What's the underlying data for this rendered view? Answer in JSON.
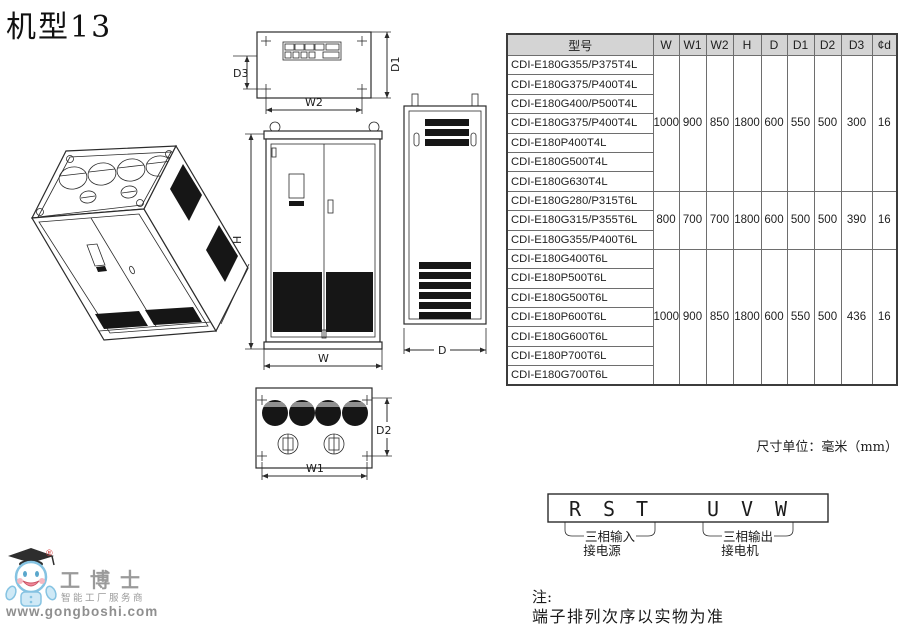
{
  "page": {
    "title": "机型13",
    "unit_note": "尺寸单位：毫米（mm）",
    "note_line1": "注:",
    "note_line2": "端子排列次序以实物为准"
  },
  "table": {
    "headers": [
      "型号",
      "W",
      "W1",
      "W2",
      "H",
      "D",
      "D1",
      "D2",
      "D3",
      "¢d"
    ],
    "groups": [
      {
        "models": [
          "CDI-E180G355/P375T4L",
          "CDI-E180G375/P400T4L",
          "CDI-E180G400/P500T4L",
          "CDI-E180G375/P400T4L",
          "CDI-E180P400T4L",
          "CDI-E180G500T4L",
          "CDI-E180G630T4L"
        ],
        "values": [
          "1000",
          "900",
          "850",
          "1800",
          "600",
          "550",
          "500",
          "300",
          "16"
        ]
      },
      {
        "models": [
          "CDI-E180G280/P315T6L",
          "CDI-E180G315/P355T6L",
          "CDI-E180G355/P400T6L"
        ],
        "values": [
          "800",
          "700",
          "700",
          "1800",
          "600",
          "500",
          "500",
          "390",
          "16"
        ]
      },
      {
        "models": [
          "CDI-E180G400T6L",
          "CDI-E180P500T6L",
          "CDI-E180G500T6L",
          "CDI-E180P600T6L",
          "CDI-E180G600T6L",
          "CDI-E180P700T6L",
          "CDI-E180G700T6L"
        ],
        "values": [
          "1000",
          "900",
          "850",
          "1800",
          "600",
          "550",
          "500",
          "436",
          "16"
        ]
      }
    ]
  },
  "drawings": {
    "top_view": {
      "d3_label": "D3",
      "d1_label": "D1",
      "w2_label": "W2"
    },
    "front_view": {
      "h_label": "H",
      "w_label": "W"
    },
    "side_view": {
      "d_label": "D"
    },
    "bottom_view": {
      "w1_label": "W1",
      "d2_label": "D2"
    }
  },
  "terminal_diagram": {
    "input_terminals": [
      "R",
      "S",
      "T"
    ],
    "output_terminals": [
      "U",
      "V",
      "W"
    ],
    "input_label_line1": "三相输入",
    "input_label_line2": "接电源",
    "output_label_line1": "三相输出",
    "output_label_line2": "接电机"
  },
  "logo": {
    "brand": "工博士",
    "registered": "®",
    "tagline": "智能工厂服务商",
    "website": "www.gongboshi.com"
  },
  "colors": {
    "table_header_bg": "#d4d4d4",
    "line_color": "#2b2b2b",
    "vent_black": "#161616",
    "logo_blue": "#85c3e2",
    "logo_gray": "#9a9a9a",
    "logo_red": "#d23c3c"
  }
}
